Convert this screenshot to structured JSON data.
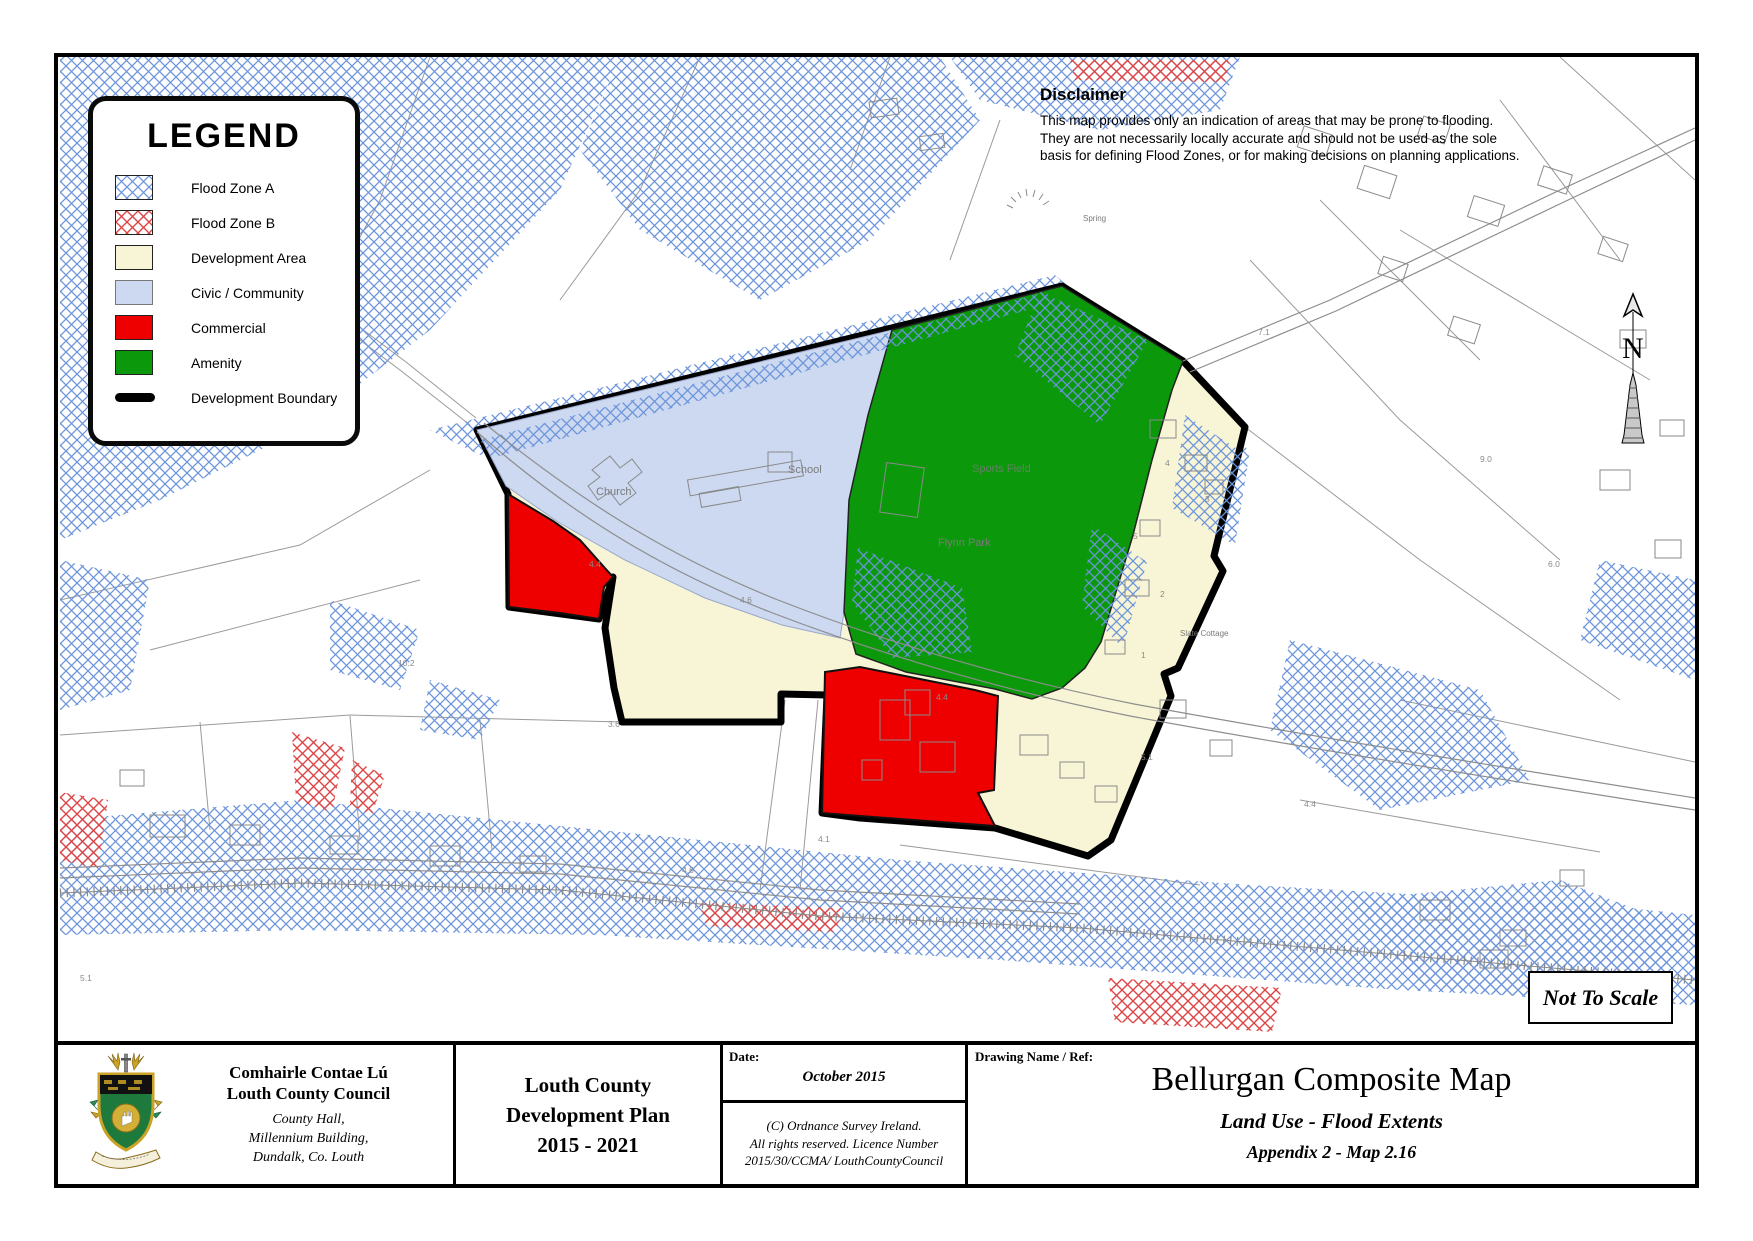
{
  "legend": {
    "title": "LEGEND",
    "items": [
      {
        "label": "Flood Zone A",
        "swatch": "hatch-blue"
      },
      {
        "label": "Flood Zone B",
        "swatch": "hatch-red"
      },
      {
        "label": "Development Area",
        "swatch": "cream"
      },
      {
        "label": "Civic / Community",
        "swatch": "lavender"
      },
      {
        "label": "Commercial",
        "swatch": "red"
      },
      {
        "label": "Amenity",
        "swatch": "green"
      }
    ],
    "boundary_label": "Development Boundary"
  },
  "disclaimer": {
    "title": "Disclaimer",
    "lines": [
      "This map provides only an indication of areas that may be prone to flooding.",
      "They are not necessarily locally accurate and should not be used as the sole",
      "basis for defining Flood Zones, or for making decisions on planning applications."
    ]
  },
  "map": {
    "north_label": "N",
    "not_to_scale": "Not To Scale",
    "labels": {
      "church": "Church",
      "school": "School",
      "sports_field": "Sports Field",
      "flynn_park": "Flynn Park",
      "cottage": "Slate Cottage",
      "spring": "Spring"
    },
    "colors": {
      "flood_zone_a": "#6b94db",
      "flood_zone_b": "#dd4444",
      "development_area": "#f8f5d7",
      "civic_community": "#ccd9f1",
      "commercial": "#ee0000",
      "amenity": "#0b990b",
      "boundary": "#000000"
    },
    "spot_labels": [
      {
        "x": 740,
        "y": 603,
        "v": "4.6"
      },
      {
        "x": 936,
        "y": 700,
        "v": "4.4"
      },
      {
        "x": 589,
        "y": 567,
        "v": "4.4"
      },
      {
        "x": 818,
        "y": 842,
        "v": "4.1"
      },
      {
        "x": 1141,
        "y": 760,
        "v": "5.1"
      },
      {
        "x": 1304,
        "y": 807,
        "v": "4.4"
      },
      {
        "x": 682,
        "y": 873,
        "v": "4.6"
      },
      {
        "x": 608,
        "y": 727,
        "v": "3.6"
      },
      {
        "x": 80,
        "y": 981,
        "v": "5.1"
      },
      {
        "x": 1480,
        "y": 462,
        "v": "9.0"
      },
      {
        "x": 1548,
        "y": 567,
        "v": "6.0"
      },
      {
        "x": 1258,
        "y": 335,
        "v": "7.1"
      },
      {
        "x": 398,
        "y": 666,
        "v": "10.2"
      },
      {
        "x": 1165,
        "y": 466,
        "v": "4"
      },
      {
        "x": 1133,
        "y": 539,
        "v": "5"
      },
      {
        "x": 1205,
        "y": 502,
        "v": "3"
      },
      {
        "x": 1160,
        "y": 597,
        "v": "2"
      },
      {
        "x": 1141,
        "y": 658,
        "v": "1"
      }
    ]
  },
  "footer": {
    "council": {
      "irish": "Comhairle Contae Lú",
      "english": "Louth County Council",
      "address": [
        "County Hall,",
        "Millennium Building,",
        "Dundalk, Co. Louth"
      ]
    },
    "plan": {
      "lines": [
        "Louth County",
        "Development Plan",
        "2015 - 2021"
      ]
    },
    "date": {
      "label": "Date:",
      "value": "October 2015",
      "copyright": [
        "(C) Ordnance Survey Ireland.",
        "All rights reserved. Licence Number",
        "2015/30/CCMA/ LouthCountyCouncil"
      ]
    },
    "drawing": {
      "label": "Drawing Name / Ref:",
      "title": "Bellurgan Composite Map",
      "subtitle": "Land Use - Flood Extents",
      "ref": "Appendix 2 - Map 2.16"
    }
  }
}
